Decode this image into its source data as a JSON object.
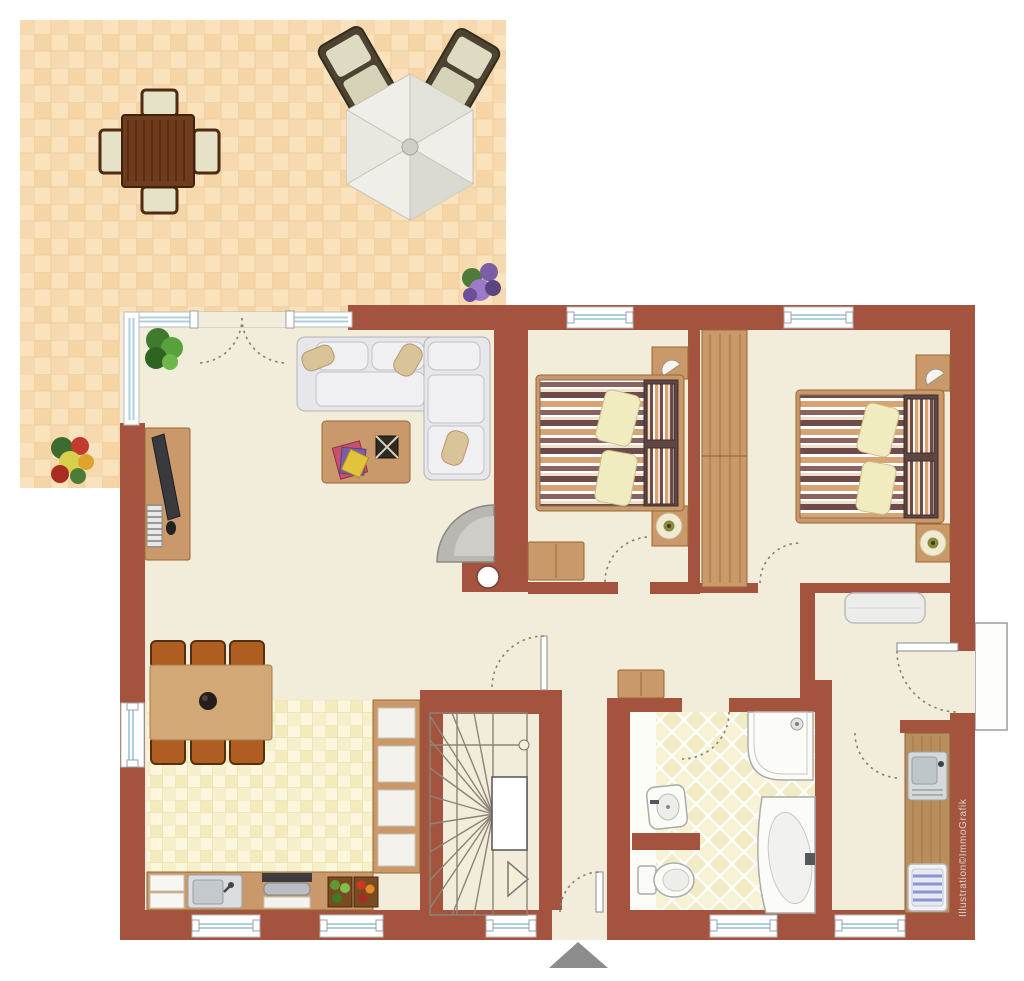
{
  "watermark": {
    "text": "Illustration©ImmoGrafik"
  },
  "palette": {
    "wall": "#A4543E",
    "interior_floor": "#F2ECDA",
    "terrace_tile": "#FAE2BC",
    "terrace_tile_alt": "#F5D5A6",
    "kitchen_tile": "#FBF6DC",
    "kitchen_tile_alt": "#F3EBBE",
    "bath_tile": "#F2ECC6",
    "wood": "#C9996B",
    "dark_wood": "#6F3D1E",
    "sofa_gray": "#E7E6EA",
    "bed_stripe_plum": "#6E4A49",
    "bed_stripe_tan": "#D9A272",
    "glass_blue": "#AFCFDF",
    "entrance_marker_gray": "#8C8C8C"
  },
  "plan": {
    "terrace": {
      "items": [
        "patio-table",
        "patio-chairs",
        "parasol",
        "sun-loungers",
        "purple-flower-plant",
        "red-flower-plant"
      ]
    },
    "living_room": {
      "items": [
        "corner-sofa",
        "coffee-table",
        "magazines",
        "desk",
        "monitor",
        "keyboard",
        "green-plant",
        "fireplace",
        "dining-table",
        "six-chairs",
        "terrace-double-door"
      ]
    },
    "kitchen": {
      "items": [
        "tall-cabinets",
        "counter",
        "sink",
        "stove",
        "vegetable-crates"
      ]
    },
    "stairs": {
      "items": [
        "winder-staircase",
        "direction-arrow",
        "newel-post"
      ]
    },
    "hallway": {
      "items": [
        "sideboard",
        "entrance-door",
        "entrance-marker"
      ]
    },
    "bedroom_1": {
      "items": [
        "double-bed",
        "bedside-tables",
        "wall-lamp",
        "table-lamp",
        "dresser",
        "window"
      ]
    },
    "bedroom_2": {
      "items": [
        "double-bed",
        "bedside-tables",
        "wardrobe",
        "wall-lamp",
        "table-lamp",
        "window"
      ]
    },
    "bathroom": {
      "items": [
        "wash-basin",
        "toilet",
        "corner-shower",
        "corner-bathtub",
        "partition-wall"
      ]
    },
    "storage_room": {
      "items": [
        "white-chest",
        "exterior-door",
        "outside-landing"
      ]
    },
    "utility_kitchenette": {
      "items": [
        "counter",
        "sink",
        "washing-machine"
      ]
    }
  }
}
